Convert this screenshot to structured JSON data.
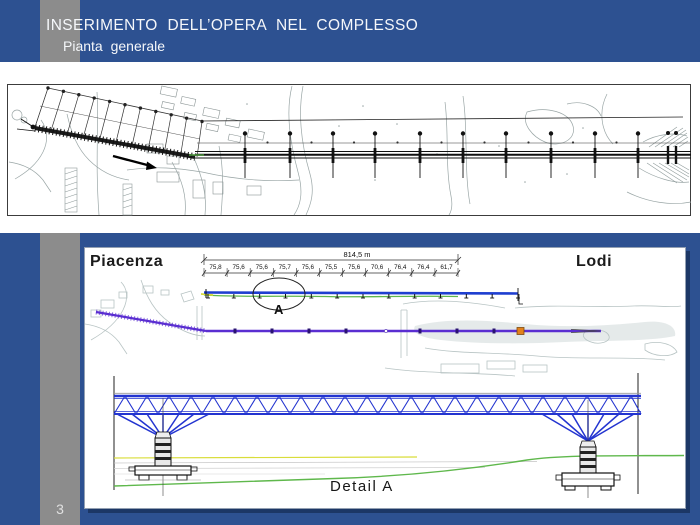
{
  "slide": {
    "title": "INSERIMENTO DELL’OPERA NEL COMPLESSO",
    "subtitle": "Pianta generale",
    "page_number": "3"
  },
  "colors": {
    "background_blue": "#2d5191",
    "stripe_gray": "#8c8c8c",
    "shadow_navy": "#1c3766",
    "truss_blue": "#2334d0",
    "deck_blue": "#1e3ed0",
    "plan_purple": "#5a2ed1",
    "ground_green": "#5fb84c",
    "ground_yellow": "#d9dd3a",
    "marker_orange": "#e2811c"
  },
  "bottom_panel": {
    "city_left": "Piacenza",
    "city_right": "Lodi",
    "total_length": "814,5 m",
    "spans": [
      "75,8",
      "75,6",
      "75,6",
      "75,7",
      "75,6",
      "75,5",
      "75,6",
      "70,6",
      "76,4",
      "76,4",
      "61,7"
    ],
    "callout_label": "A",
    "detail_label": "Detail A"
  }
}
